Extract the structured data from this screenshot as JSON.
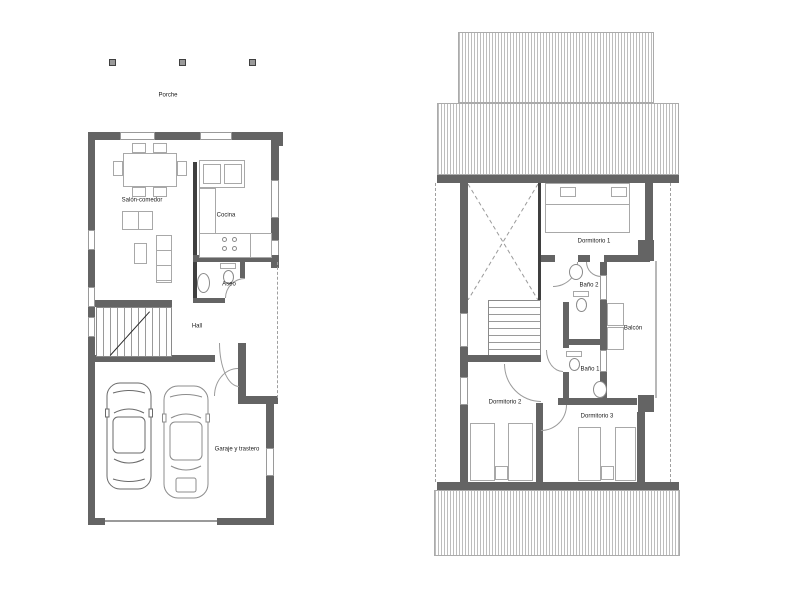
{
  "floor_plans": {
    "ground_floor": {
      "porch_label": "Porche",
      "living_dining_label": "Salón-comedor",
      "kitchen_label": "Cocina",
      "toilet_label": "Aseo",
      "hall_label": "Hall",
      "garage_label": "Garaje y trastero"
    },
    "upper_floor": {
      "bedroom1_label": "Dormitorio 1",
      "bath2_label": "Baño 2",
      "balcony_label": "Balcón",
      "bath1_label": "Baño 1",
      "bedroom2_label": "Dormitorio 2",
      "bedroom3_label": "Dormitorio 3"
    },
    "colors": {
      "wall": "#646464",
      "thin_wall": "#3f3f3f",
      "drawing_line": "#9a9a9a",
      "hatch_line": "#bdbdbd",
      "text": "#1a1a1a",
      "background": "#ffffff"
    }
  }
}
